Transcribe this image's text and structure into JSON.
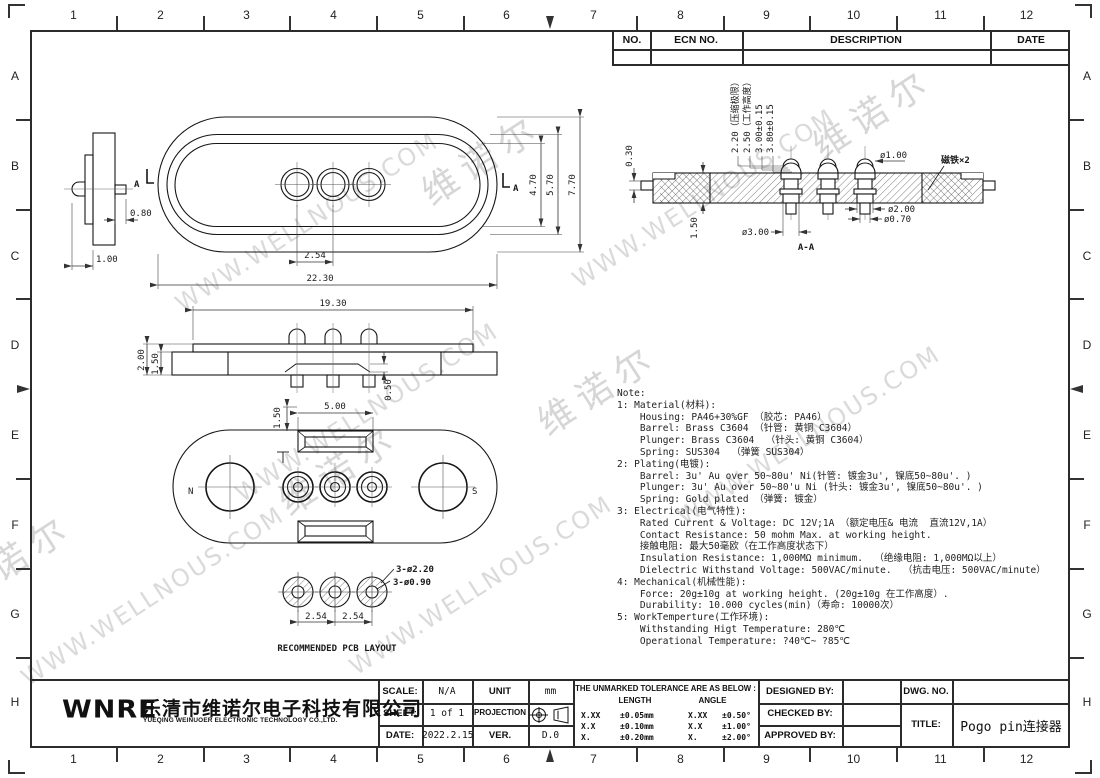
{
  "frame": {
    "cols": [
      "1",
      "2",
      "3",
      "4",
      "5",
      "6",
      "7",
      "8",
      "9",
      "10",
      "11",
      "12"
    ],
    "rows": [
      "A",
      "B",
      "C",
      "D",
      "E",
      "F",
      "G",
      "H"
    ]
  },
  "ecn": {
    "no": "NO.",
    "ecn_no": "ECN  NO.",
    "description": "DESCRIPTION",
    "date": "DATE"
  },
  "watermarks": {
    "url": "WWW.WELLNOUS.COM",
    "brand": "维诺尔"
  },
  "dims": {
    "side_080": "0.80",
    "side_100": "1.00",
    "top_a_left": "A",
    "top_a_right": "A",
    "top_254": "2.54",
    "top_2230": "22.30",
    "top_470": "4.70",
    "top_570": "5.70",
    "top_770": "7.70",
    "front_1930": "19.30",
    "front_200": "2.00",
    "front_150": "1.50",
    "front_050": "0.50",
    "bot_150": "1.50",
    "bot_500": "5.00",
    "bot_n": "N",
    "bot_s": "S",
    "pcb_220": "3-ø2.20",
    "pcb_090": "3-ø0.90",
    "pcb_254a": "2.54",
    "pcb_254b": "2.54",
    "pcb_caption": "RECOMMENDED PCB LAYOUT",
    "sec_220": "2.20（压缩极限）",
    "sec_250": "2.50（工作高度）",
    "sec_300": "3.00±0.15",
    "sec_380": "3.80±0.15",
    "sec_100": "ø1.00",
    "sec_magnet": "磁铁×2",
    "sec_200": "ø2.00",
    "sec_070": "ø0.70",
    "sec_d300": "ø3.00",
    "sec_150": "1.50",
    "sec_030": "0.30",
    "sec_caption": "A-A"
  },
  "notes": {
    "lines": [
      "Note:",
      "1: Material(材料):",
      "    Housing: PA46+30%GF （胶芯: PA46）",
      "    Barrel: Brass C3604 （针管: 黄铜 C3604）",
      "    Plunger: Brass C3604  （针头: 黄铜 C3604）",
      "    Spring: SUS304  （弹簧 SUS304）",
      "2: Plating(电镀):",
      "    Barrel: 3u' Au over 50~80u' Ni(针管: 镀金3u', 镍底50~80u'. )",
      "    Plunger: 3u' Au over 50~80'u Ni (针头: 镀金3u', 镍底50~80u'. )",
      "    Spring: Gold plated （弹簧: 镀金）",
      "3: Electrical(电气特性):",
      "    Rated Current & Voltage: DC 12V;1A （额定电压& 电流  直流12V,1A）",
      "    Contact Resistance: 50 mohm Max. at working height.",
      "    接触电阻: 最大50毫欧（在工作高度状态下）",
      "    Insulation Resistance: 1,000MΩ minimum.  （绝缘电阻: 1,000MΩ以上）",
      "    Dielectric Withstand Voltage: 500VAC/minute.  （抗击电压: 500VAC/minute）",
      "4: Mechanical(机械性能):",
      "    Force: 20g±10g at working height. (20g±10g 在工作高度）.",
      "    Durability: 10.000 cycles(min)（寿命: 10000次）",
      "5: WorkTemperture(工作环境):",
      "    Withstanding Higt Temperature: 280℃",
      "    Operational Temperature: ?40℃~ ?85℃"
    ]
  },
  "title_block": {
    "company_logo": "WNRE",
    "company_cn": "乐清市维诺尔电子科技有限公司",
    "company_en": "YUEQING WEINUOER ELECTRONIC TECHNOLOGY CO.,LTD.",
    "scale_label": "SCALE:",
    "scale_value": "N/A",
    "unit_label": "UNIT",
    "unit_value": "mm",
    "sheet_label": "SHEET:",
    "sheet_value": "1 of 1",
    "projection_label": "PROJECTION",
    "date_label": "DATE:",
    "date_value": "2022.2.15",
    "ver_label": "VER.",
    "ver_value": "D.0",
    "tolerance_title": "THE UNMARKED TOLERANCE ARE AS BELOW :",
    "length_label": "LENGTH",
    "angle_label": "ANGLE",
    "tol_rows": [
      {
        "l1": "X.XX",
        "l2": "±0.05mm",
        "a1": "X.XX",
        "a2": "±0.50°"
      },
      {
        "l1": "X.X",
        "l2": "±0.10mm",
        "a1": "X.X",
        "a2": "±1.00°"
      },
      {
        "l1": "X.",
        "l2": "±0.20mm",
        "a1": "X.",
        "a2": "±2.00°"
      }
    ],
    "designed_by": "DESIGNED BY:",
    "checked_by": "CHECKED BY:",
    "approved_by": "APPROVED BY:",
    "dwg_no": "DWG. NO.",
    "title_label": "TITLE:",
    "title_value": "Pogo pin连接器"
  }
}
